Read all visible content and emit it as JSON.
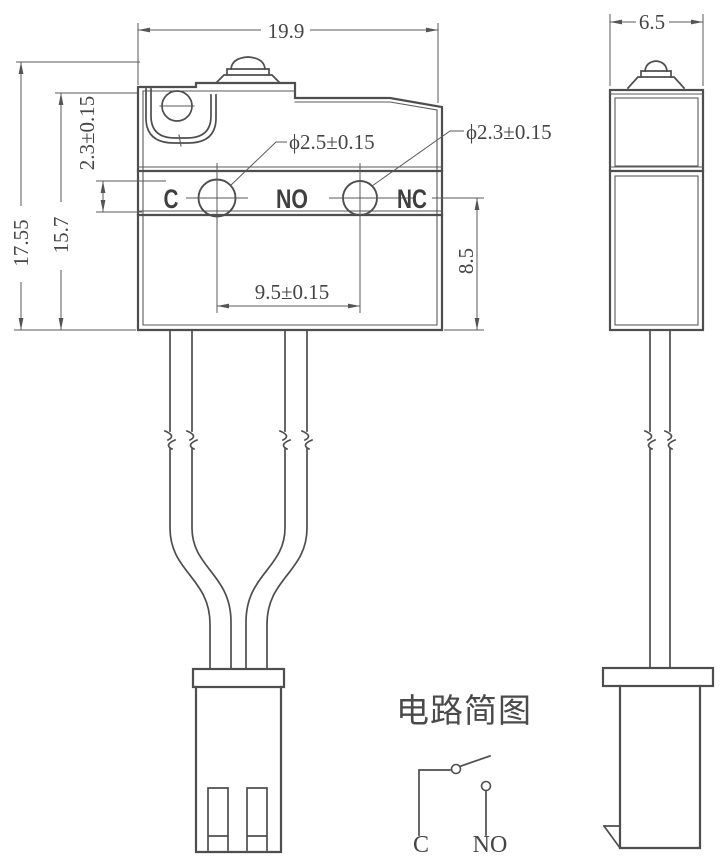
{
  "dimensions": {
    "overall_width": "19.9",
    "overall_height": "17.55",
    "body_height": "15.7",
    "terminal_band": "2.3±0.15",
    "hole_c": "ϕ2.5±0.15",
    "hole_nc": "ϕ2.3±0.15",
    "hole_pitch": "9.5±0.15",
    "lower_height": "8.5",
    "side_width": "6.5"
  },
  "terminals": {
    "common": "C",
    "normally_open": "NO",
    "normally_closed": "NC"
  },
  "circuit": {
    "title": "电路简图",
    "common": "C",
    "normally_open": "NO"
  },
  "colors": {
    "line": "#4e4e4e",
    "dim_line": "#5a5a5a",
    "text": "#454545"
  }
}
